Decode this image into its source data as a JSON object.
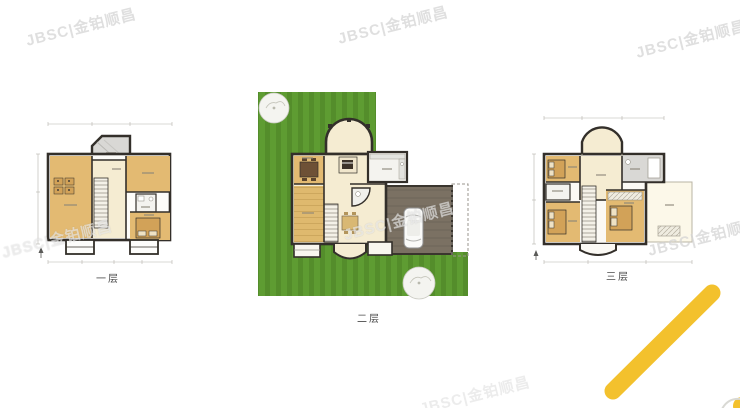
{
  "page": {
    "description": "Real-estate listing floor plan sheet with three villa storeys",
    "background": "#ffffff"
  },
  "watermark": {
    "text": "JBSC|金铂顺昌"
  },
  "floors": [
    {
      "id": "first",
      "label": "一层"
    },
    {
      "id": "second",
      "label": "二层"
    },
    {
      "id": "third",
      "label": "三层"
    }
  ],
  "colors": {
    "wall": "#332f2a",
    "room_tan": "#e3ba72",
    "room_tan_dark": "#d2a258",
    "room_cream": "#f5ecd2",
    "room_white": "#f4f3ef",
    "room_gray": "#d9d8d5",
    "lawn": "#5e9c32",
    "lawn_stripe": "#548d2b",
    "driveway": "#7b7163",
    "driveway_line": "#6b6255",
    "accent_yellow": "#f3c12d",
    "dim_line": "#b5b2ac",
    "label_text": "#4a4a4a",
    "watermark_gray": "rgba(176,176,176,0.40)",
    "watermark_white": "rgba(255,255,255,0.55)"
  }
}
